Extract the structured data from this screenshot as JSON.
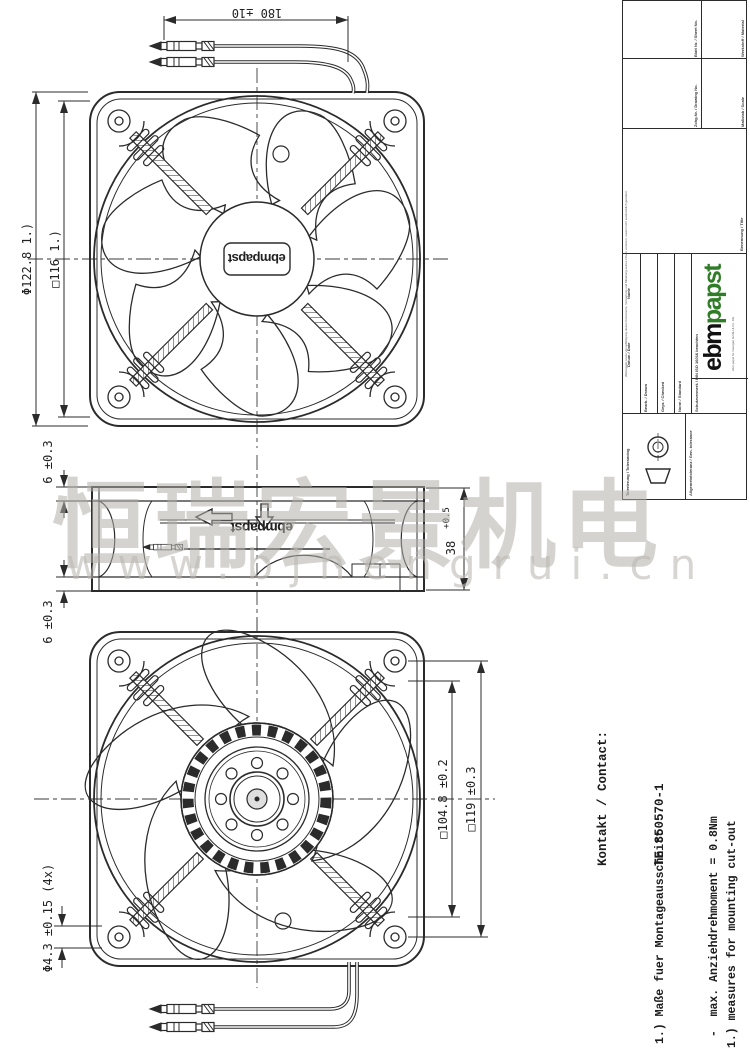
{
  "watermark": {
    "cjk": "恒瑞宏景机电",
    "url": "www.bjhengrui.cn"
  },
  "views": {
    "front": {
      "dim_wire_length": "180 ±10",
      "dim_outer_diameter": "Φ122.8 1.)",
      "dim_square": "□116 1.)",
      "hub_logo": "ebmpapst"
    },
    "side": {
      "dim_flange_top": "6 ±0.3",
      "dim_flange_bottom": "6 ±0.3",
      "dim_depth_value": "38",
      "dim_depth_tol": "+0.5",
      "logo": "ebmpapst"
    },
    "rear": {
      "dim_cutout": "□104.8 ±0.2",
      "dim_frame": "□119 ±0.3",
      "dim_hole_dia": "Φ4.3 ±0.15 (4x)"
    }
  },
  "notes": {
    "contact_line1": "Kontakt / Contact:",
    "contact_line2": "TE 350570-1",
    "german": [
      "1.) Maße fuer Montageausschnitt",
      " -  max. Anziehdrehmoment = 0.8Nm",
      " -  Axialspiel: mit Feder spielfrei verspannt"
    ],
    "english": [
      "1.) measures for mounting cut-out",
      " -  max. tightening torque = 0.8Nm",
      " -  without axial clearance by a pre-loaded spring"
    ]
  },
  "title_block": {
    "logo_ebm": "ebm",
    "logo_papst": "papst",
    "labels": {
      "notice": "Weitergabe sowie Vervielfältigung dieses Dokuments, Verwertung und Mitteilung seines Inhalts verboten, soweit nicht ausdrücklich gestattet.",
      "tolerancing": "Tolerierung / Tolerancing",
      "general_tolerance": "Allgemeintoleranz / Gen. tolerance",
      "protection": "Schutzvermerk / DIN ISO 16016 beachten",
      "date": "Datum / Date",
      "name": "Name",
      "drawn": "Bearb. / Drawn",
      "checked": "Gepr. / Checked",
      "norm": "Norm / Standard",
      "title_label": "Benennung / Title",
      "drawing_no": "Zchg.Nr. / Drawing No.",
      "sheet": "Blatt Nr. / Sheet No.",
      "scale": "Maßstab / Scale",
      "material": "Werkstoff / Material",
      "company": "ebm-papst St. Georgen GmbH & Co. KG"
    }
  },
  "colors": {
    "line": "#2b2b2b",
    "watermark_gray": "#b2afaa",
    "logo_green": "#2f7d26"
  }
}
